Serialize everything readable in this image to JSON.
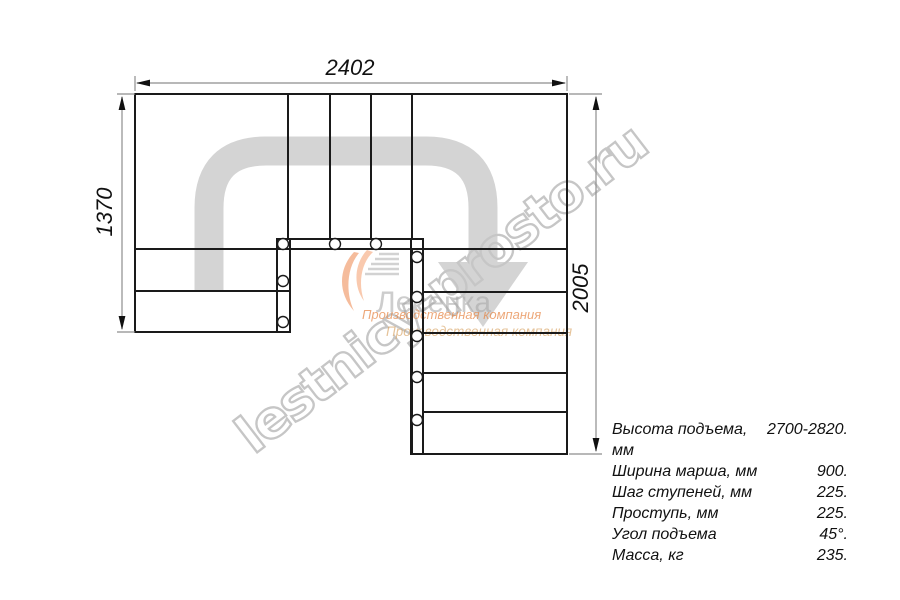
{
  "drawing": {
    "dim_width": "2402",
    "dim_left": "1370",
    "dim_right": "2005"
  },
  "watermark": {
    "site": "lestnicy-prosto.ru",
    "brand": "Лесенка",
    "tagline1": "Производственная компания",
    "tagline2": "Производственная компания"
  },
  "specs": {
    "rows": [
      {
        "label": "Высота подъема, мм",
        "value": "2700-2820."
      },
      {
        "label": "Ширина марша, мм",
        "value": "900."
      },
      {
        "label": "Шаг ступеней, мм",
        "value": "225."
      },
      {
        "label": "Проступь, мм",
        "value": "225."
      },
      {
        "label": "Угол подъема",
        "value": "45°."
      },
      {
        "label": "Масса, кг",
        "value": "235."
      }
    ]
  },
  "colors": {
    "line": "#1a1a1a",
    "dimension_line": "#8e8e8e",
    "watermark_gray": "#d4d4d4",
    "watermark_outline": "#c6c6c6",
    "logo_orange": "#e5813d",
    "logo_tan": "#d9a668",
    "logo_gray": "#a6a6a6"
  }
}
